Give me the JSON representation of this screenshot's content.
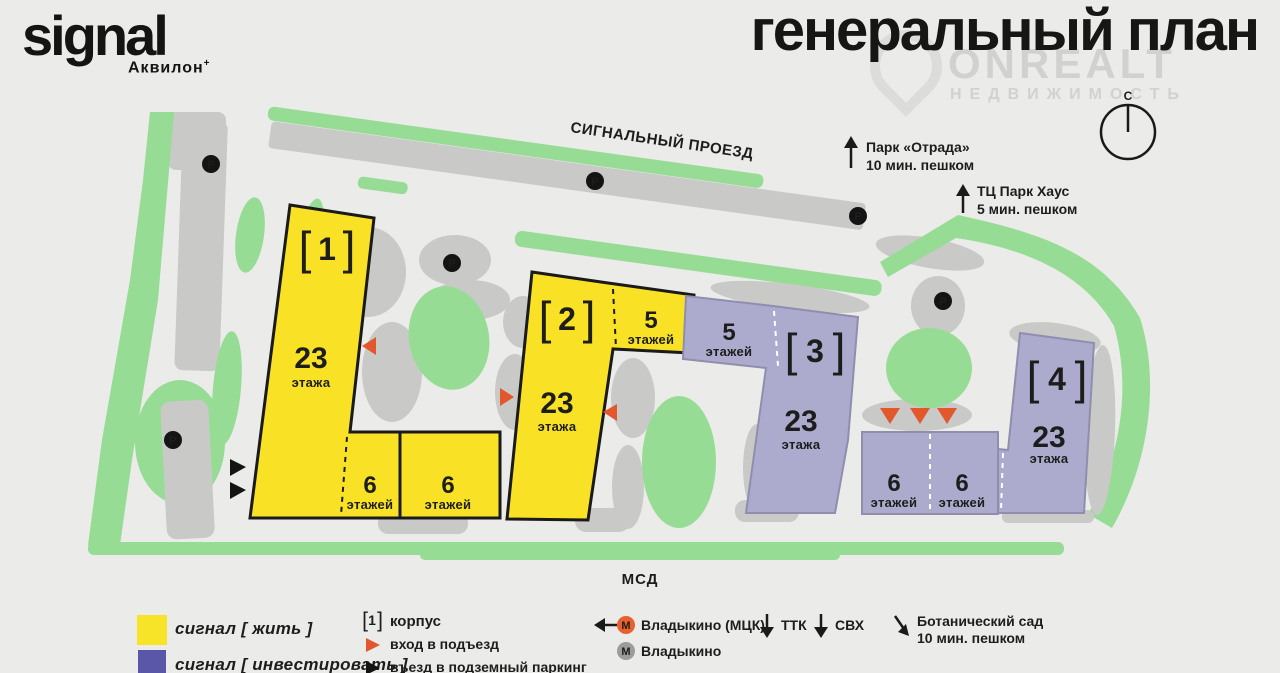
{
  "header": {
    "logo": "signal",
    "logo_sub": "Аквилон",
    "logo_mark": "+",
    "title": "генеральный план"
  },
  "watermark": {
    "brand": "ONREALT",
    "sub": "НЕДВИЖИМОСТЬ"
  },
  "compass": {
    "north": "С"
  },
  "map": {
    "street": "СИГНАЛЬНЫЙ ПРОЕЗД",
    "highway": "МСД",
    "parking_letter": "P",
    "bl": "[",
    "br": "]",
    "poi_park": {
      "name": "Парк «Отрада»",
      "time": "10 мин. пешком"
    },
    "poi_mall": {
      "name": "ТЦ Парк Хаус",
      "time": "5 мин. пешком"
    },
    "b1": {
      "num": "1",
      "floors": "23",
      "unit": "этажа"
    },
    "b1w1": {
      "floors": "6",
      "unit": "этажей"
    },
    "b1w2": {
      "floors": "6",
      "unit": "этажей"
    },
    "b2": {
      "num": "2",
      "floors": "23",
      "unit": "этажа"
    },
    "b2w5": {
      "floors": "5",
      "unit": "этажей"
    },
    "b3": {
      "num": "3",
      "floors": "23",
      "unit": "этажа"
    },
    "b3w5": {
      "floors": "5",
      "unit": "этажей"
    },
    "b3w1": {
      "floors": "6",
      "unit": "этажей"
    },
    "b3w2": {
      "floors": "6",
      "unit": "этажей"
    },
    "b4": {
      "num": "4",
      "floors": "23",
      "unit": "этажа"
    }
  },
  "legend": {
    "live": "сигнал [ жить ]",
    "invest": "сигнал [ инвестировать ]",
    "korpus_num": "1",
    "korpus": "корпус",
    "entrance": "вход в подъезд",
    "parking": "въезд в подземный паркинг",
    "metro_letter": "М",
    "metro_mck": "Владыкино (МЦК)",
    "metro": "Владыкино",
    "ttk": "ТТК",
    "svh": "СВХ",
    "botanic": "Ботанический сад",
    "botanic_time": "10 мин. пешком"
  },
  "colors": {
    "background": "#EBEBE9",
    "ink": "#1D1D1B",
    "live_yellow": "#F7E327",
    "invest_lavender": "#ACABCE",
    "legend_purple": "#5B57A8",
    "entrance_orange": "#E2572B",
    "greenery": "#96DC94",
    "parking_gray": "#C9C9C7",
    "metro_orange": "#E8612C",
    "metro_gray": "#9C9C9A"
  }
}
